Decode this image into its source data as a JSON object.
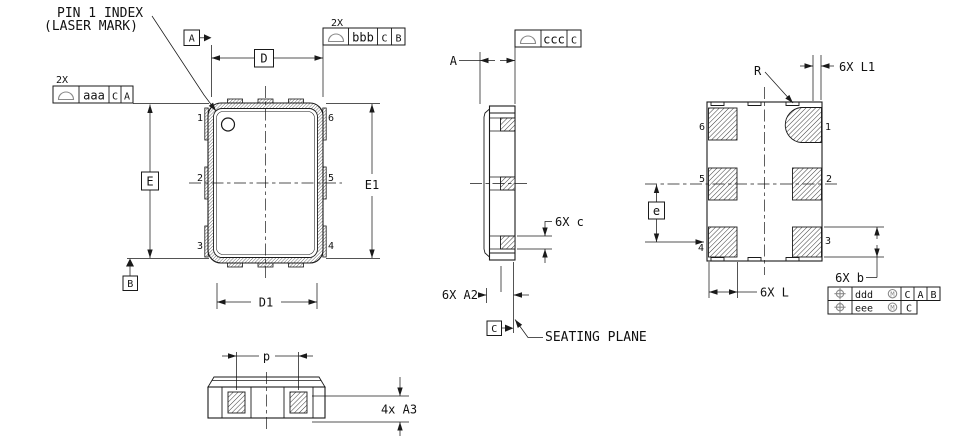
{
  "texts": {
    "pin1_line1": "PIN 1 INDEX",
    "pin1_line2": "(LASER MARK)",
    "seating_plane": "SEATING PLANE",
    "radius": "R"
  },
  "dims": {
    "D": "D",
    "D1": "D1",
    "E": "E",
    "E1": "E1",
    "A": "A",
    "p": "p",
    "a3": "4x A3",
    "c": "6X c",
    "a2": "6X A2",
    "L": "6X L",
    "L1": "6X L1",
    "b": "6X b",
    "e": "e"
  },
  "datums": {
    "A": "A",
    "B": "B",
    "C": "C"
  },
  "fcf": {
    "qty2x": "2X",
    "aaa": {
      "tol": "aaa",
      "ref1": "C",
      "ref2": "A"
    },
    "bbb": {
      "tol": "bbb",
      "ref1": "C",
      "ref2": "B"
    },
    "ccc": {
      "tol": "ccc",
      "ref1": "C"
    },
    "ddd": {
      "tol": "ddd",
      "ref1": "C",
      "ref2": "A",
      "ref3": "B"
    },
    "eee": {
      "tol": "eee",
      "ref1": "C"
    },
    "mod": "M"
  },
  "pins": {
    "n1": "1",
    "n2": "2",
    "n3": "3",
    "n4": "4",
    "n5": "5",
    "n6": "6"
  }
}
